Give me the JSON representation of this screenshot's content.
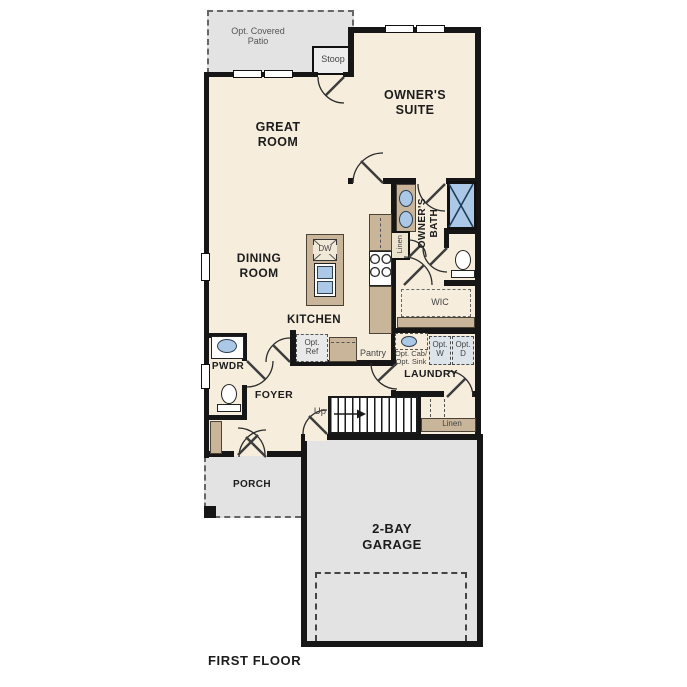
{
  "plan": {
    "title": "FIRST FLOOR",
    "rooms": {
      "patio": "Opt. Covered Patio",
      "stoop": "Stoop",
      "owners_suite": "OWNER'S SUITE",
      "great_room": "GREAT ROOM",
      "dining_room": "DINING ROOM",
      "kitchen": "KITCHEN",
      "owners_bath": "OWNER'S BATH",
      "wic": "WIC",
      "pwdr": "PWDR",
      "foyer": "FOYER",
      "laundry": "LAUNDRY",
      "porch": "PORCH",
      "garage": "2-BAY GARAGE"
    },
    "features": {
      "dishwasher": "DW",
      "pantry": "Pantry",
      "opt_ref": "Opt. Ref",
      "opt_cab_sink": "Opt. Cab/ Opt. Sink",
      "opt_washer": "Opt. W",
      "opt_dryer": "Opt. D",
      "linen_bath": "Linen",
      "linen_hall": "Linen",
      "stairs_up": "Up"
    }
  },
  "colors": {
    "wall": "#161616",
    "floor": "#f6eddc",
    "outdoor": "#e3e3e3",
    "counter": "#c9b59a",
    "fixture_blue": "#abc9e7",
    "text": "#1c1c1c",
    "muted_text": "#444444"
  }
}
